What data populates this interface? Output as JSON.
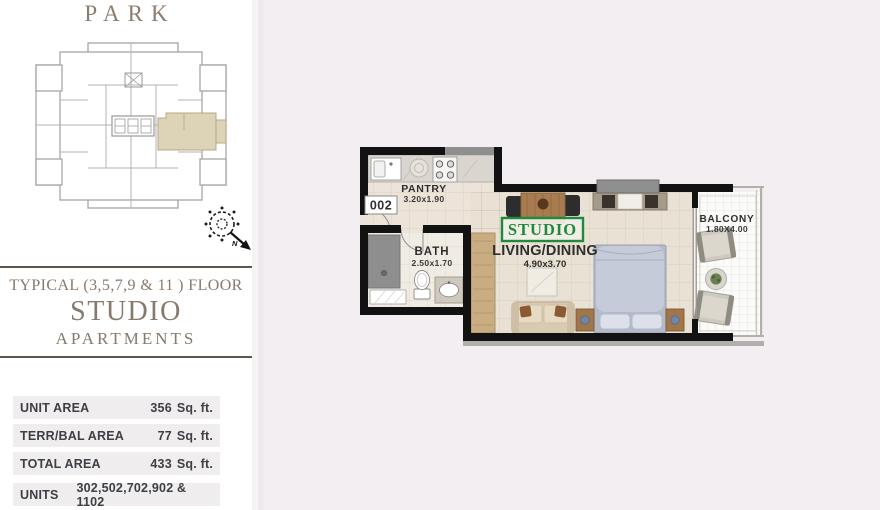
{
  "brand": {
    "title": "PARK"
  },
  "heading": {
    "floor_line": "TYPICAL (3,5,7,9 & 11 ) FLOOR",
    "unit_type": "STUDIO",
    "subtitle": "APARTMENTS"
  },
  "area_table": {
    "rows": [
      {
        "label": "UNIT AREA",
        "value": "356",
        "unit": "Sq. ft."
      },
      {
        "label": "TERR/BAL AREA",
        "value": "77",
        "unit": "Sq. ft."
      },
      {
        "label": "TOTAL AREA",
        "value": "433",
        "unit": "Sq. ft."
      },
      {
        "label": "UNITS",
        "value": "302,502,702,902 & 1102",
        "unit": ""
      }
    ]
  },
  "floor_plan": {
    "unit_number": "002",
    "unit_type_tag": "STUDIO",
    "rooms": {
      "pantry": {
        "name": "PANTRY",
        "dims": "3.20x1.90"
      },
      "bath": {
        "name": "BATH",
        "dims": "2.50x1.70"
      },
      "living": {
        "name": "LIVING/DINING",
        "dims": "4.90x3.70"
      },
      "balcony": {
        "name": "BALCONY",
        "dims": "1.80X4.00"
      }
    }
  },
  "compass": {
    "north_label": "N"
  },
  "colors": {
    "accent_green": "#1f8a3d",
    "heading_brown": "#8b7d6f",
    "divider_brown": "#5d544b",
    "panel_pink": "#f2eef2",
    "floor_beige": "#eae2d6",
    "wall_black": "#121212",
    "keyplan_highlight": "#ddd3b6"
  }
}
